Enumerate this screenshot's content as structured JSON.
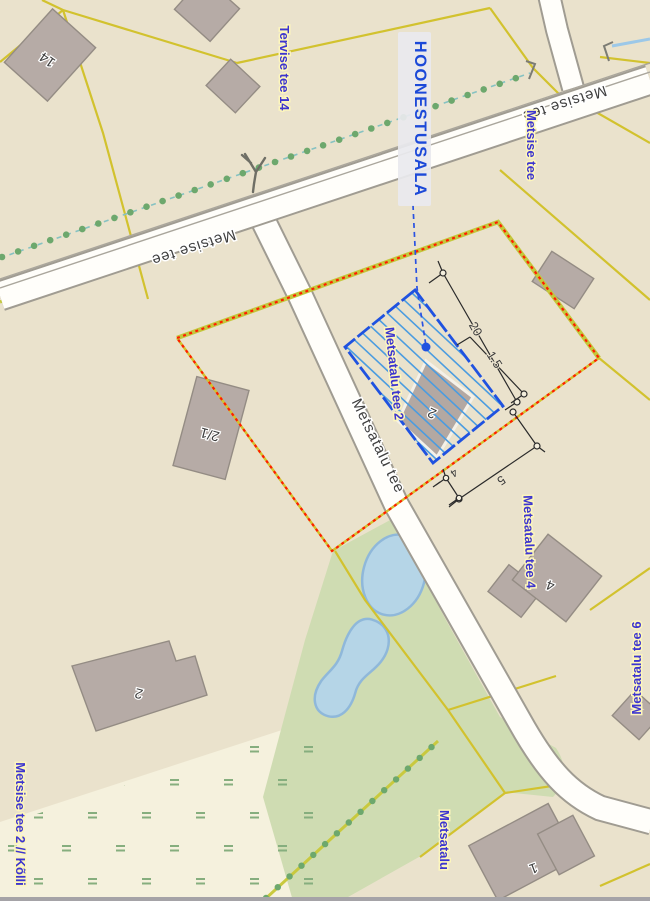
{
  "labels": {
    "plan_area": "HOONESTUSALA",
    "street_metsise_1": "Metsise tee",
    "street_metsise_2": "Metsise tee",
    "street_metsatalu": "Metsatalu tee",
    "addr_tervise_14": "Tervise tee 14",
    "addr_metsise": "Metsise tee",
    "addr_metsatalu_2": "Metsatalu tee 2",
    "addr_metsatalu_4": "Metsatalu tee 4",
    "addr_metsatalu_6": "Metsatalu tee 6",
    "addr_metsise_2_kolli": "Metsise tee 2 // Kõlli",
    "addr_metsatalu_bottom": "Metsatalu"
  },
  "buildings": {
    "b14": "14",
    "b2_1": "2/1",
    "b2_plan": "2",
    "b2_sw": "2",
    "b4": "4",
    "b1": "1"
  },
  "dimensions": {
    "d_20": "20",
    "d_1_5": "1.5",
    "d_5": "5",
    "d_4": "4"
  },
  "colors": {
    "base_land": "#eae2cc",
    "wetland": "#f5f1dd",
    "meadow": "#cfdcb2",
    "pond_fill": "#b5d5e7",
    "pond_stroke": "#8fb8da",
    "road_fill": "#fffefa",
    "road_casing": "#a09c92",
    "parcel_yellow": "#d2c22e",
    "boundary_underlay": "#c3c83c",
    "boundary_red": "#ff1e00",
    "plan_blue": "#1f52e0",
    "hatch_blue": "#4b9ce0",
    "address_blue": "#3d35cf",
    "label_halo": "#fdf6bc",
    "building_fill": "#b6aba6",
    "tree_dot_green": "#6da86d",
    "tree_dash_teal": "#86c2c2",
    "wet_mark_green": "#86ae7e",
    "ditch_blue": "#9cc8e8"
  }
}
